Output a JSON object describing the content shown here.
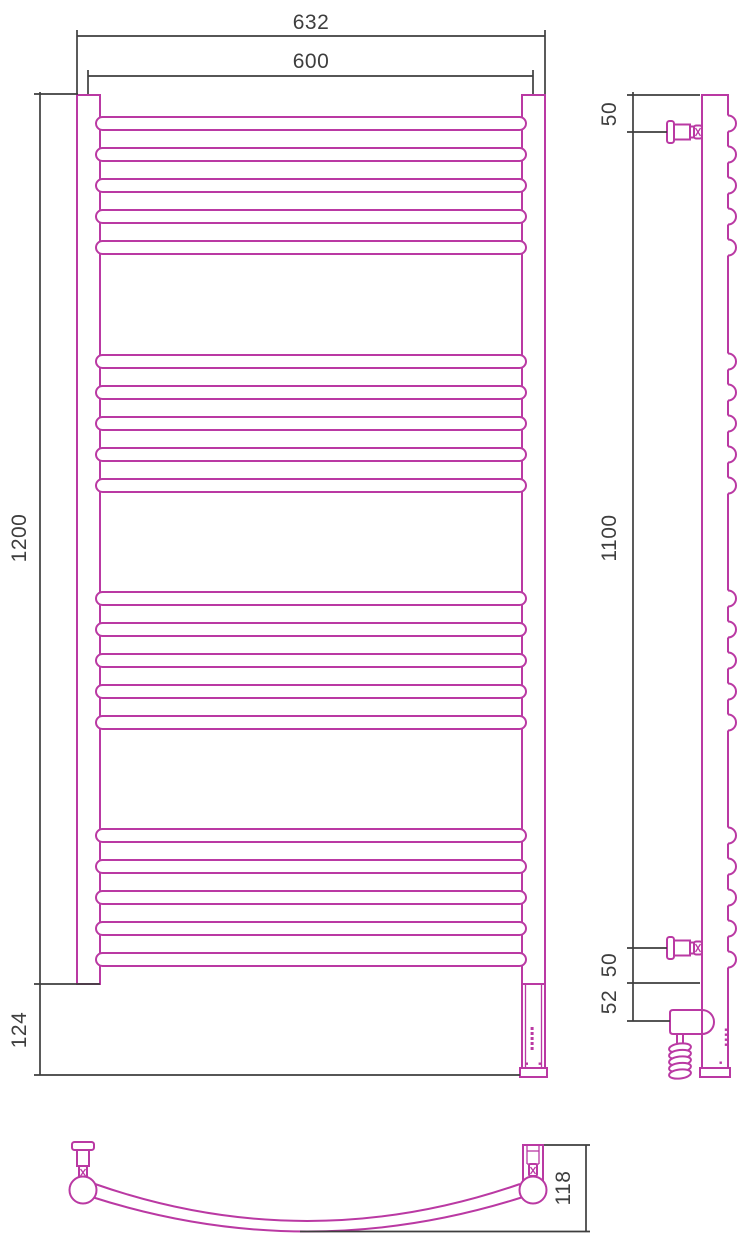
{
  "title": "Heated towel rail — dimensional drawing (front, side and bottom views)",
  "colors": {
    "line": "#ba39a3",
    "dim": "#3e3e3e",
    "bg": "#ffffff"
  },
  "front": {
    "width_outer": "632",
    "width_axes": "600",
    "height_body": "1200",
    "height_base": "124",
    "rail_count": 20,
    "rail_rows": [
      117,
      148,
      179,
      210,
      241,
      355,
      386,
      417,
      448,
      479,
      592,
      623,
      654,
      685,
      716,
      829,
      860,
      891,
      922,
      953
    ]
  },
  "side": {
    "top_offset": "50",
    "bracket_span": "1100",
    "bottom_offset": "50",
    "heater_offset": "52"
  },
  "bottom": {
    "depth": "118"
  }
}
